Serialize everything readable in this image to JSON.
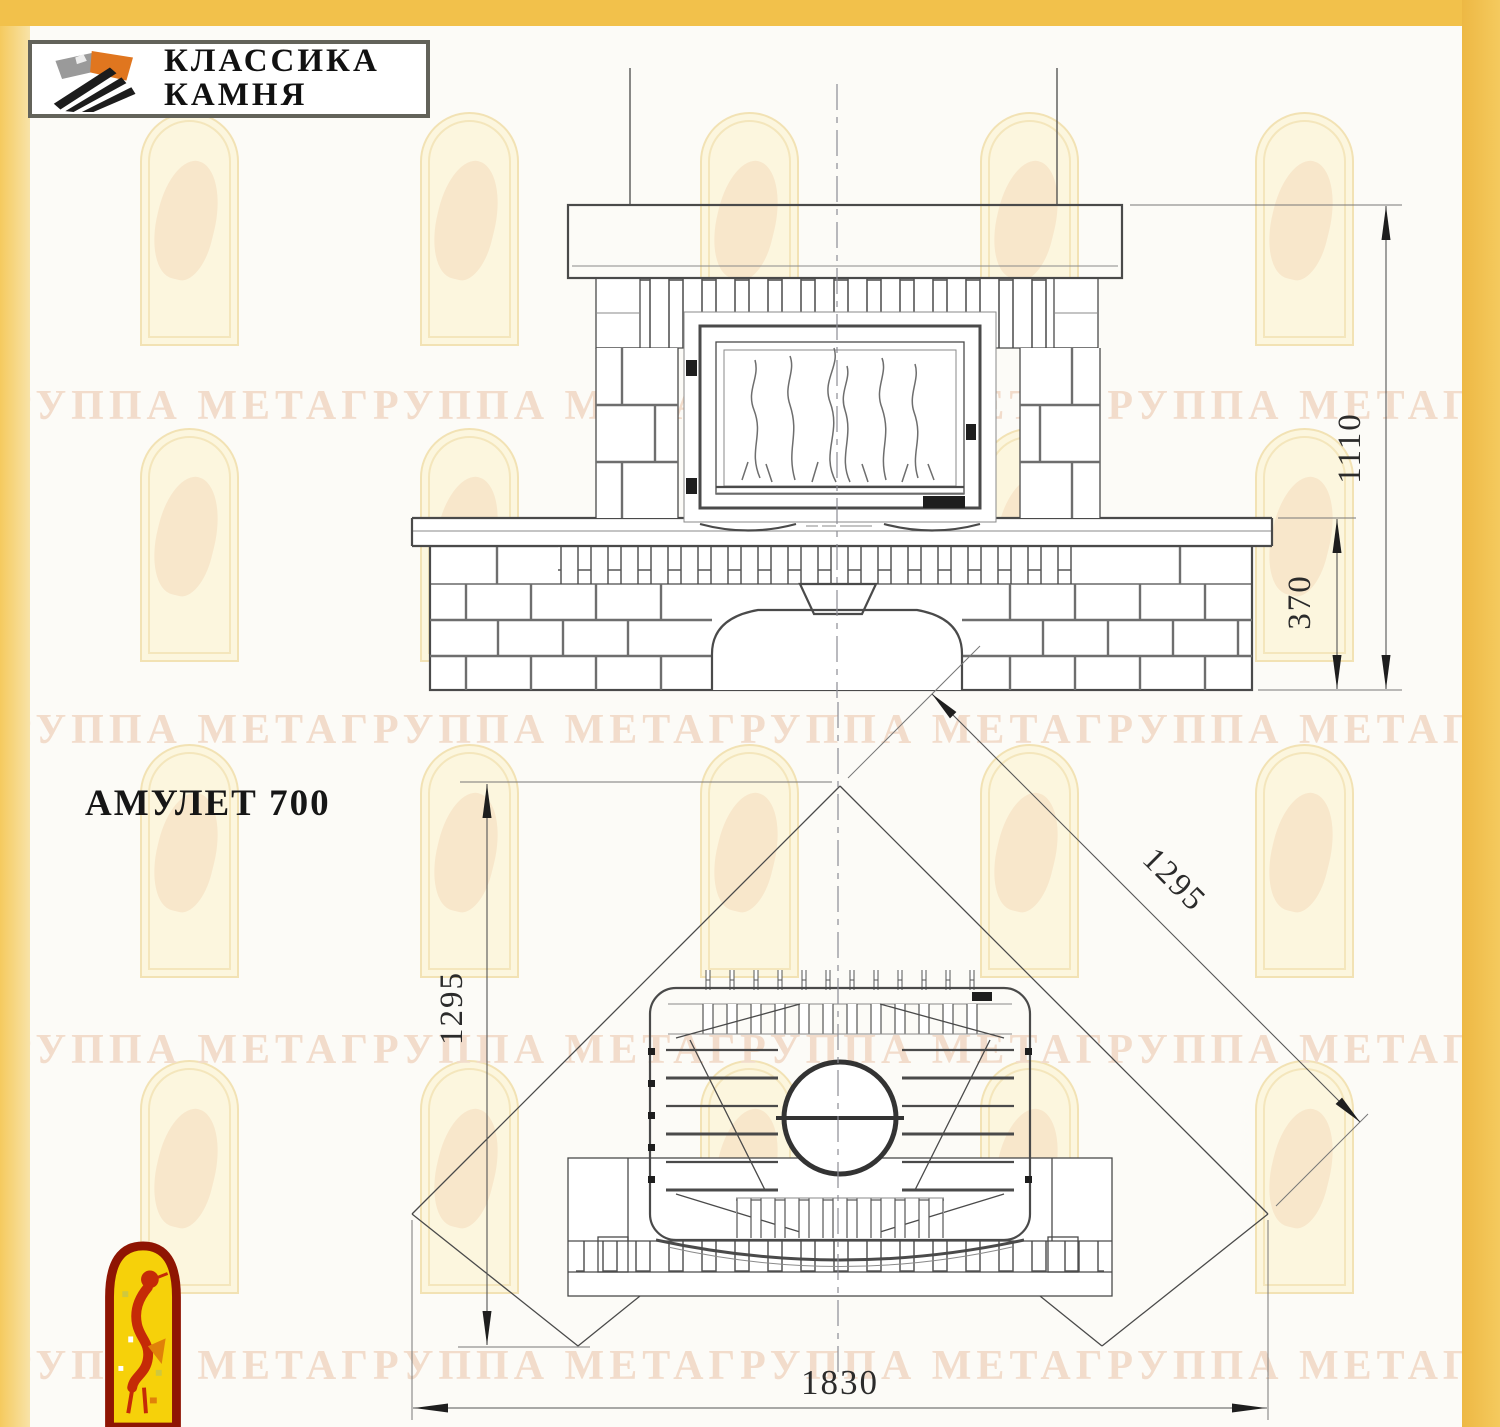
{
  "brand": {
    "line1": "КЛАССИКА",
    "line2": "КАМНЯ"
  },
  "title": "АМУЛЕТ 700",
  "watermark": {
    "phrase": "ГРУППА МЕТАГРУППА МЕТАГРУППА МЕТАГРУППА МЕТАГРУППА"
  },
  "colors": {
    "accent_bar": "#F2C14B",
    "drawing_line": "#4A4A4A",
    "dimension_text": "#2B2B2B",
    "watermark_text": "#F2DCCB",
    "watermark_arch": "#F2E2B4",
    "logo_orange": "#E0761F",
    "logo_gray": "#9A9A9A",
    "emblem_red": "#A81C04",
    "emblem_yellow": "#F6D10A"
  },
  "front_view": {
    "dims": {
      "total_height": "1110",
      "bench_height": "370"
    }
  },
  "plan_view": {
    "dims": {
      "depth": "1295",
      "side": "1295",
      "width": "1830"
    }
  }
}
